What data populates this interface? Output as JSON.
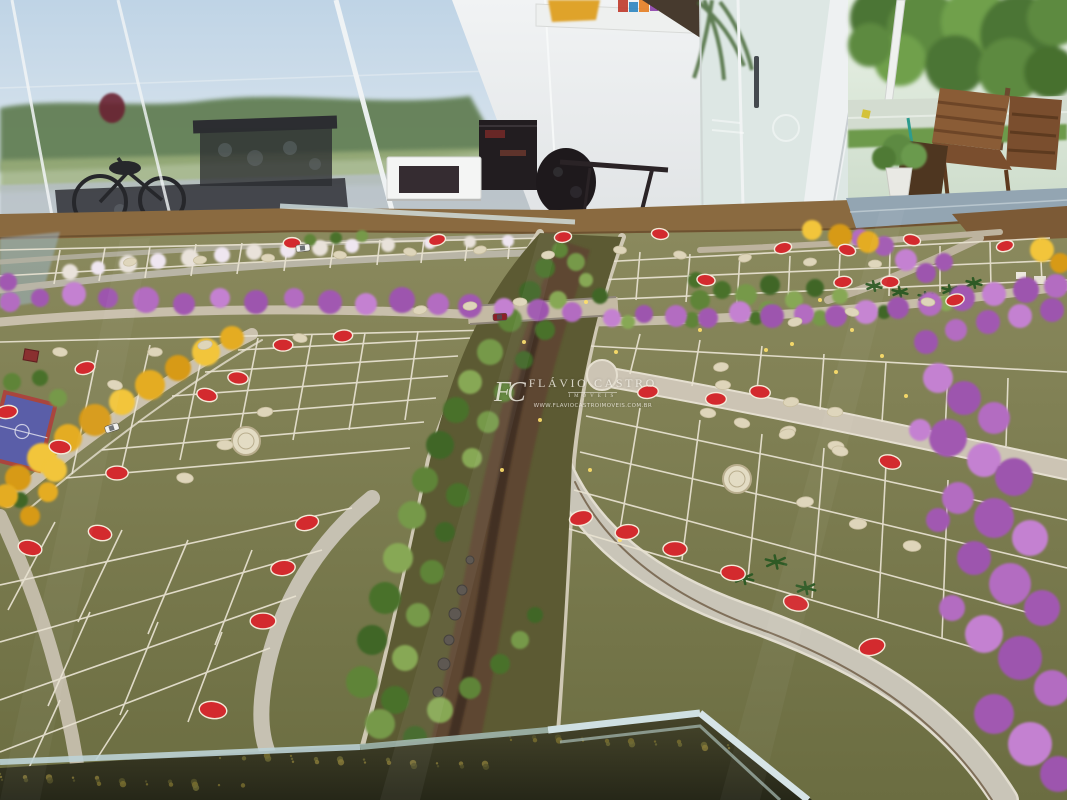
{
  "scene": {
    "type": "photograph",
    "subject": "Scale model (maquete) of a residential lot subdivision displayed inside a glass-walled sales showroom",
    "environment": "showroom interior with glass walls, white wall and cabinet, ornate dark furniture, outdoor trees, wooden deck chairs and street visible outside"
  },
  "watermark": {
    "monogram": "FC",
    "name": "FLÁVIO CASTRO",
    "subtitle": "IMÓVEIS",
    "url": "WWW.FLAVIOCASTROIMOVEIS.COM.BR"
  },
  "palette": {
    "sky": "#bfd4e6",
    "wall": "#ebedee",
    "glass": "#dde7e4",
    "outside_green": "#5d8a40",
    "lot_green": "#75764a",
    "lot_line": "#e9e3d2",
    "road": "#cbc2ae",
    "road_blue_gray": "#93a5b2",
    "earth_edge": "#8a6a40",
    "soil": "#5e4631",
    "creek": "#3f2f20",
    "red_marker": "#d32a2e",
    "marker_rim": "#f3ead9",
    "cream_marker": "#ded5ba",
    "medallion": "#e3dcc4",
    "purple_shades": [
      "#b36cc1",
      "#a159b1",
      "#c481d1",
      "#9d55ae"
    ],
    "yellow_shades": [
      "#e4ac20",
      "#f2c53a",
      "#d79a16"
    ],
    "green_shades": [
      "#5f8438",
      "#49712c",
      "#76994a",
      "#3f6626",
      "#87a855"
    ],
    "white_tree": "#e9e2da",
    "palm_green": "#2e5a25",
    "sparkle": "#ffe06a",
    "court_blue": "#5a5ea8",
    "court_border": "#a9453e",
    "case_frame": "#cfe0e2",
    "watermark_color": "#f3efe6"
  },
  "model": {
    "red_markers": [
      [
        437,
        240
      ],
      [
        563,
        237
      ],
      [
        292,
        243
      ],
      [
        660,
        234
      ],
      [
        912,
        240
      ],
      [
        1005,
        246
      ],
      [
        343,
        336
      ],
      [
        283,
        345
      ],
      [
        238,
        378
      ],
      [
        207,
        395
      ],
      [
        85,
        368
      ],
      [
        7,
        412
      ],
      [
        117,
        473
      ],
      [
        60,
        447
      ],
      [
        100,
        533
      ],
      [
        307,
        523
      ],
      [
        283,
        568
      ],
      [
        263,
        621
      ],
      [
        213,
        710
      ],
      [
        30,
        548
      ],
      [
        581,
        518
      ],
      [
        627,
        532
      ],
      [
        675,
        549
      ],
      [
        733,
        573
      ],
      [
        796,
        603
      ],
      [
        872,
        647
      ],
      [
        648,
        392
      ],
      [
        716,
        399
      ],
      [
        760,
        392
      ],
      [
        890,
        462
      ],
      [
        783,
        248
      ],
      [
        843,
        282
      ],
      [
        890,
        282
      ],
      [
        706,
        280
      ],
      [
        847,
        250
      ],
      [
        955,
        300
      ]
    ],
    "cream_markers": [
      [
        130,
        262
      ],
      [
        200,
        260
      ],
      [
        268,
        258
      ],
      [
        340,
        255
      ],
      [
        410,
        252
      ],
      [
        480,
        250
      ],
      [
        548,
        255
      ],
      [
        155,
        352
      ],
      [
        60,
        352
      ],
      [
        115,
        385
      ],
      [
        205,
        345
      ],
      [
        265,
        412
      ],
      [
        225,
        445
      ],
      [
        185,
        478
      ],
      [
        300,
        338
      ],
      [
        420,
        310
      ],
      [
        470,
        306
      ],
      [
        520,
        302
      ],
      [
        620,
        250
      ],
      [
        680,
        255
      ],
      [
        745,
        258
      ],
      [
        810,
        262
      ],
      [
        875,
        264
      ],
      [
        928,
        302
      ],
      [
        852,
        312
      ],
      [
        795,
        322
      ],
      [
        721,
        367
      ],
      [
        723,
        385
      ],
      [
        708,
        413
      ],
      [
        742,
        423
      ],
      [
        788,
        431
      ],
      [
        791,
        402
      ],
      [
        835,
        412
      ],
      [
        836,
        446
      ],
      [
        840,
        451
      ],
      [
        787,
        434
      ],
      [
        805,
        502
      ],
      [
        858,
        524
      ],
      [
        912,
        546
      ]
    ],
    "medallions": [
      [
        246,
        441
      ],
      [
        737,
        479
      ]
    ],
    "purple_trees": [
      [
        10,
        302,
        10
      ],
      [
        40,
        298,
        9
      ],
      [
        74,
        294,
        12
      ],
      [
        108,
        298,
        10
      ],
      [
        146,
        300,
        13
      ],
      [
        184,
        304,
        11
      ],
      [
        220,
        298,
        10
      ],
      [
        256,
        302,
        12
      ],
      [
        294,
        298,
        10
      ],
      [
        330,
        302,
        12
      ],
      [
        366,
        304,
        11
      ],
      [
        402,
        300,
        13
      ],
      [
        438,
        304,
        11
      ],
      [
        470,
        306,
        12
      ],
      [
        504,
        308,
        10
      ],
      [
        538,
        310,
        11
      ],
      [
        572,
        312,
        10
      ],
      [
        8,
        282,
        9
      ],
      [
        612,
        318,
        9
      ],
      [
        644,
        314,
        9
      ],
      [
        676,
        316,
        11
      ],
      [
        708,
        318,
        10
      ],
      [
        740,
        312,
        11
      ],
      [
        772,
        316,
        12
      ],
      [
        804,
        314,
        10
      ],
      [
        836,
        316,
        11
      ],
      [
        866,
        312,
        12
      ],
      [
        898,
        308,
        11
      ],
      [
        930,
        304,
        12
      ],
      [
        962,
        298,
        13
      ],
      [
        994,
        294,
        12
      ],
      [
        1026,
        290,
        13
      ],
      [
        1056,
        286,
        12
      ],
      [
        884,
        246,
        10
      ],
      [
        906,
        260,
        11
      ],
      [
        926,
        273,
        10
      ],
      [
        860,
        238,
        9
      ],
      [
        944,
        262,
        9
      ],
      [
        938,
        378,
        15
      ],
      [
        964,
        398,
        17
      ],
      [
        994,
        418,
        16
      ],
      [
        948,
        438,
        19
      ],
      [
        984,
        460,
        17
      ],
      [
        1014,
        477,
        19
      ],
      [
        958,
        498,
        16
      ],
      [
        994,
        518,
        20
      ],
      [
        1030,
        538,
        18
      ],
      [
        974,
        558,
        17
      ],
      [
        1010,
        584,
        21
      ],
      [
        1042,
        608,
        18
      ],
      [
        984,
        634,
        19
      ],
      [
        1020,
        658,
        22
      ],
      [
        1052,
        688,
        18
      ],
      [
        994,
        714,
        20
      ],
      [
        1030,
        744,
        22
      ],
      [
        1058,
        774,
        18
      ],
      [
        952,
        608,
        13
      ],
      [
        938,
        520,
        12
      ],
      [
        920,
        430,
        11
      ],
      [
        926,
        342,
        12
      ],
      [
        956,
        330,
        11
      ],
      [
        988,
        322,
        12
      ],
      [
        1020,
        316,
        12
      ],
      [
        1052,
        310,
        12
      ]
    ],
    "yellow_trees": [
      [
        232,
        338,
        12
      ],
      [
        206,
        352,
        14
      ],
      [
        178,
        368,
        13
      ],
      [
        150,
        385,
        15
      ],
      [
        122,
        402,
        13
      ],
      [
        95,
        420,
        16
      ],
      [
        68,
        438,
        14
      ],
      [
        42,
        458,
        15
      ],
      [
        18,
        478,
        13
      ],
      [
        6,
        496,
        12
      ],
      [
        55,
        470,
        12
      ],
      [
        30,
        516,
        10
      ],
      [
        48,
        492,
        10
      ],
      [
        812,
        230,
        10
      ],
      [
        840,
        236,
        12
      ],
      [
        868,
        242,
        11
      ],
      [
        1042,
        250,
        12
      ],
      [
        1060,
        263,
        10
      ]
    ],
    "green_trees": [
      [
        560,
        250,
        8
      ],
      [
        545,
        268,
        10
      ],
      [
        576,
        262,
        9
      ],
      [
        530,
        292,
        11
      ],
      [
        558,
        300,
        9
      ],
      [
        510,
        320,
        12
      ],
      [
        545,
        330,
        10
      ],
      [
        490,
        352,
        13
      ],
      [
        524,
        360,
        9
      ],
      [
        470,
        382,
        12
      ],
      [
        504,
        392,
        10
      ],
      [
        456,
        410,
        13
      ],
      [
        488,
        422,
        11
      ],
      [
        440,
        445,
        14
      ],
      [
        472,
        458,
        10
      ],
      [
        425,
        480,
        13
      ],
      [
        458,
        495,
        12
      ],
      [
        412,
        515,
        14
      ],
      [
        445,
        532,
        10
      ],
      [
        398,
        558,
        15
      ],
      [
        432,
        572,
        12
      ],
      [
        385,
        598,
        16
      ],
      [
        418,
        615,
        12
      ],
      [
        372,
        640,
        15
      ],
      [
        405,
        658,
        13
      ],
      [
        362,
        682,
        16
      ],
      [
        395,
        700,
        14
      ],
      [
        380,
        724,
        15
      ],
      [
        415,
        738,
        12
      ],
      [
        440,
        710,
        13
      ],
      [
        470,
        688,
        11
      ],
      [
        500,
        664,
        10
      ],
      [
        520,
        640,
        9
      ],
      [
        535,
        615,
        8
      ],
      [
        628,
        322,
        7
      ],
      [
        692,
        320,
        8
      ],
      [
        756,
        318,
        7
      ],
      [
        820,
        318,
        8
      ],
      [
        884,
        312,
        7
      ],
      [
        946,
        303,
        8
      ],
      [
        700,
        300,
        10
      ],
      [
        722,
        290,
        9
      ],
      [
        746,
        295,
        11
      ],
      [
        770,
        285,
        10
      ],
      [
        794,
        300,
        9
      ],
      [
        740,
        310,
        8
      ],
      [
        696,
        280,
        8
      ],
      [
        768,
        310,
        9
      ],
      [
        815,
        288,
        9
      ],
      [
        840,
        296,
        8
      ],
      [
        310,
        240,
        6
      ],
      [
        336,
        238,
        6
      ],
      [
        362,
        236,
        6
      ],
      [
        600,
        296,
        8
      ],
      [
        586,
        280,
        7
      ],
      [
        12,
        382,
        9
      ],
      [
        40,
        378,
        8
      ],
      [
        58,
        398,
        9
      ],
      [
        20,
        500,
        8
      ]
    ],
    "white_trees": [
      [
        70,
        272,
        8
      ],
      [
        98,
        268,
        7
      ],
      [
        128,
        264,
        9
      ],
      [
        158,
        261,
        8
      ],
      [
        190,
        258,
        9
      ],
      [
        222,
        255,
        8
      ],
      [
        254,
        252,
        8
      ],
      [
        288,
        250,
        8
      ],
      [
        320,
        248,
        8
      ],
      [
        352,
        246,
        7
      ],
      [
        388,
        245,
        7
      ],
      [
        430,
        243,
        6
      ],
      [
        470,
        242,
        6
      ],
      [
        508,
        241,
        6
      ]
    ],
    "palm_trees": [
      [
        744,
        578,
        10
      ],
      [
        776,
        562,
        11
      ],
      [
        806,
        588,
        10
      ],
      [
        874,
        286,
        8
      ],
      [
        900,
        292,
        8
      ],
      [
        926,
        297,
        8
      ],
      [
        950,
        290,
        8
      ],
      [
        974,
        283,
        8
      ]
    ],
    "sparkle_dots": [
      [
        820,
        300
      ],
      [
        852,
        330
      ],
      [
        882,
        356
      ],
      [
        792,
        344
      ],
      [
        524,
        342
      ],
      [
        540,
        420
      ],
      [
        502,
        470
      ],
      [
        586,
        302
      ],
      [
        616,
        352
      ],
      [
        700,
        330
      ],
      [
        766,
        350
      ],
      [
        836,
        372
      ],
      [
        906,
        396
      ],
      [
        590,
        470
      ],
      [
        620,
        540
      ]
    ],
    "cars": [
      {
        "x": 112,
        "y": 428,
        "rot": -18,
        "color": "#f2f2ee"
      },
      {
        "x": 303,
        "y": 248,
        "rot": -6,
        "color": "#f2f2ee"
      },
      {
        "x": 500,
        "y": 317,
        "rot": -3,
        "color": "#8c2026"
      }
    ]
  }
}
